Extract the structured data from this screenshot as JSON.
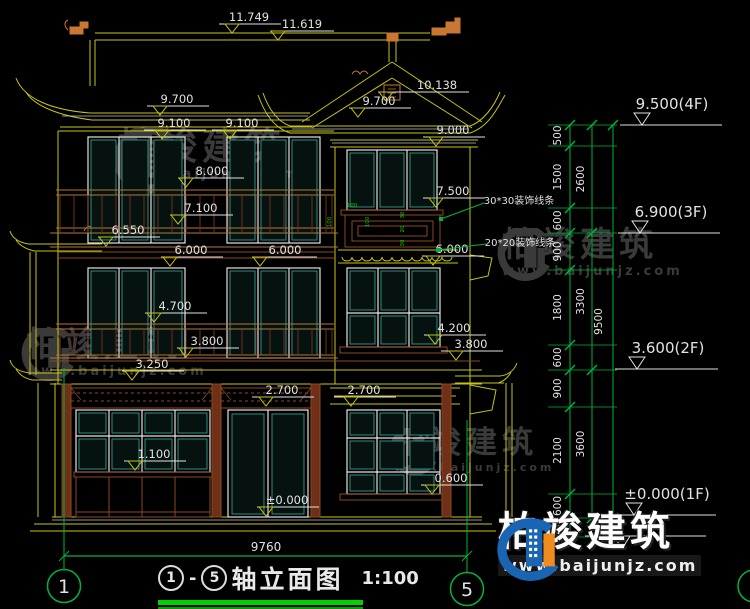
{
  "title": {
    "axis_start": "1",
    "separator": "-",
    "axis_end": "5",
    "name": "轴立面图",
    "scale": "1:100"
  },
  "grid": {
    "left_label": "1",
    "right_label": "5"
  },
  "overall_dim": "9760",
  "watermark": {
    "name": "柏竣建筑",
    "url": "www.baijunjz.com"
  },
  "callouts": [
    {
      "v": "30*30装饰线条",
      "cx": 519,
      "cy": 200,
      "x1": 484,
      "y1": 203,
      "x2": 441,
      "y2": 219
    },
    {
      "v": "20*20装饰线条",
      "cx": 520,
      "cy": 242,
      "x1": 486,
      "y1": 244,
      "x2": 438,
      "y2": 250
    }
  ],
  "panel_dims": [
    {
      "v": "100",
      "x": 352,
      "y": 207,
      "rot": 0
    },
    {
      "v": "100",
      "x": 331,
      "y": 222,
      "rot": -90
    },
    {
      "v": "100",
      "x": 369,
      "y": 222,
      "rot": -90
    },
    {
      "v": "30",
      "x": 404,
      "y": 215,
      "rot": -90
    },
    {
      "v": "20",
      "x": 404,
      "y": 229,
      "rot": -90
    },
    {
      "v": "30",
      "x": 404,
      "y": 243,
      "rot": -90
    }
  ],
  "elevation_marks": [
    {
      "v": "11.749",
      "tx": 232,
      "ty": 33,
      "cx": 249
    },
    {
      "v": "11.619",
      "tx": 278,
      "ty": 40,
      "cx": 302
    },
    {
      "v": "10.138",
      "tx": 386,
      "ty": 101,
      "cx": 437
    },
    {
      "v": "9.700",
      "tx": 160,
      "ty": 115,
      "cx": 177
    },
    {
      "v": "9.700",
      "tx": 358,
      "ty": 117,
      "cx": 379
    },
    {
      "v": "9.100",
      "tx": 162,
      "ty": 139,
      "cx": 174
    },
    {
      "v": "9.100",
      "tx": 230,
      "ty": 139,
      "cx": 242
    },
    {
      "v": "9.000",
      "tx": 436,
      "ty": 146,
      "cx": 453
    },
    {
      "v": "8.000",
      "tx": 186,
      "ty": 187,
      "cx": 212
    },
    {
      "v": "7.500",
      "tx": 436,
      "ty": 207,
      "cx": 453
    },
    {
      "v": "7.100",
      "tx": 178,
      "ty": 224,
      "cx": 201
    },
    {
      "v": "6.550",
      "tx": 106,
      "ty": 246,
      "cx": 128
    },
    {
      "v": "6.000",
      "tx": 170,
      "ty": 266,
      "cx": 191
    },
    {
      "v": "6.000",
      "tx": 260,
      "ty": 266,
      "cx": 285
    },
    {
      "v": "6.000",
      "tx": 433,
      "ty": 265,
      "cx": 452
    },
    {
      "v": "4.700",
      "tx": 154,
      "ty": 322,
      "cx": 175
    },
    {
      "v": "4.200",
      "tx": 435,
      "ty": 344,
      "cx": 454
    },
    {
      "v": "3.800",
      "tx": 186,
      "ty": 357,
      "cx": 207
    },
    {
      "v": "3.800",
      "tx": 456,
      "ty": 360,
      "cx": 471
    },
    {
      "v": "3.250",
      "tx": 132,
      "ty": 380,
      "cx": 152
    },
    {
      "v": "2.700",
      "tx": 266,
      "ty": 406,
      "cx": 282
    },
    {
      "v": "2.700",
      "tx": 351,
      "ty": 406,
      "cx": 364
    },
    {
      "v": "1.100",
      "tx": 135,
      "ty": 470,
      "cx": 154
    },
    {
      "v": "±0.000",
      "tx": 266,
      "ty": 516,
      "cx": 287
    },
    {
      "v": "0.600",
      "tx": 432,
      "ty": 494,
      "cx": 451
    }
  ],
  "level_markers": [
    {
      "v": "9.500(4F)",
      "y": 125,
      "x1": 620,
      "x2": 722,
      "cx": 672
    },
    {
      "v": "6.900(3F)",
      "y": 233,
      "x1": 618,
      "x2": 720,
      "cx": 671
    },
    {
      "v": "3.600(2F)",
      "y": 369,
      "x1": 615,
      "x2": 718,
      "cx": 668
    },
    {
      "v": "±0.000(1F)",
      "y": 515,
      "x1": 612,
      "x2": 716,
      "cx": 667
    }
  ],
  "dim_chains": {
    "inner": {
      "x": 570,
      "tx": 561,
      "bounds": [
        125,
        146,
        208,
        233,
        270,
        345,
        370,
        407,
        494,
        518,
        537
      ],
      "vals": [
        "500",
        "1500",
        "600",
        "900",
        "1800",
        "600",
        "900",
        "2100",
        "600",
        "450"
      ]
    },
    "mid": {
      "x": 592,
      "tx": 584,
      "bounds": [
        125,
        233,
        370,
        518
      ],
      "vals": [
        "2600",
        "3300",
        "3600"
      ]
    },
    "outer": {
      "x": 613,
      "tx": 602,
      "bounds": [
        125,
        518
      ],
      "vals": [
        "9500"
      ]
    }
  },
  "colors": {
    "line_yellow": "#c8c414",
    "dim_green": "#00b43c",
    "accent_green": "#00d400",
    "text_white": "#e2e2e2",
    "wood_brown": "#8a4a1e",
    "glass_teal": "#2e8f82",
    "logo_blue": "#1a64b4",
    "logo_orange": "#f08c1e"
  }
}
